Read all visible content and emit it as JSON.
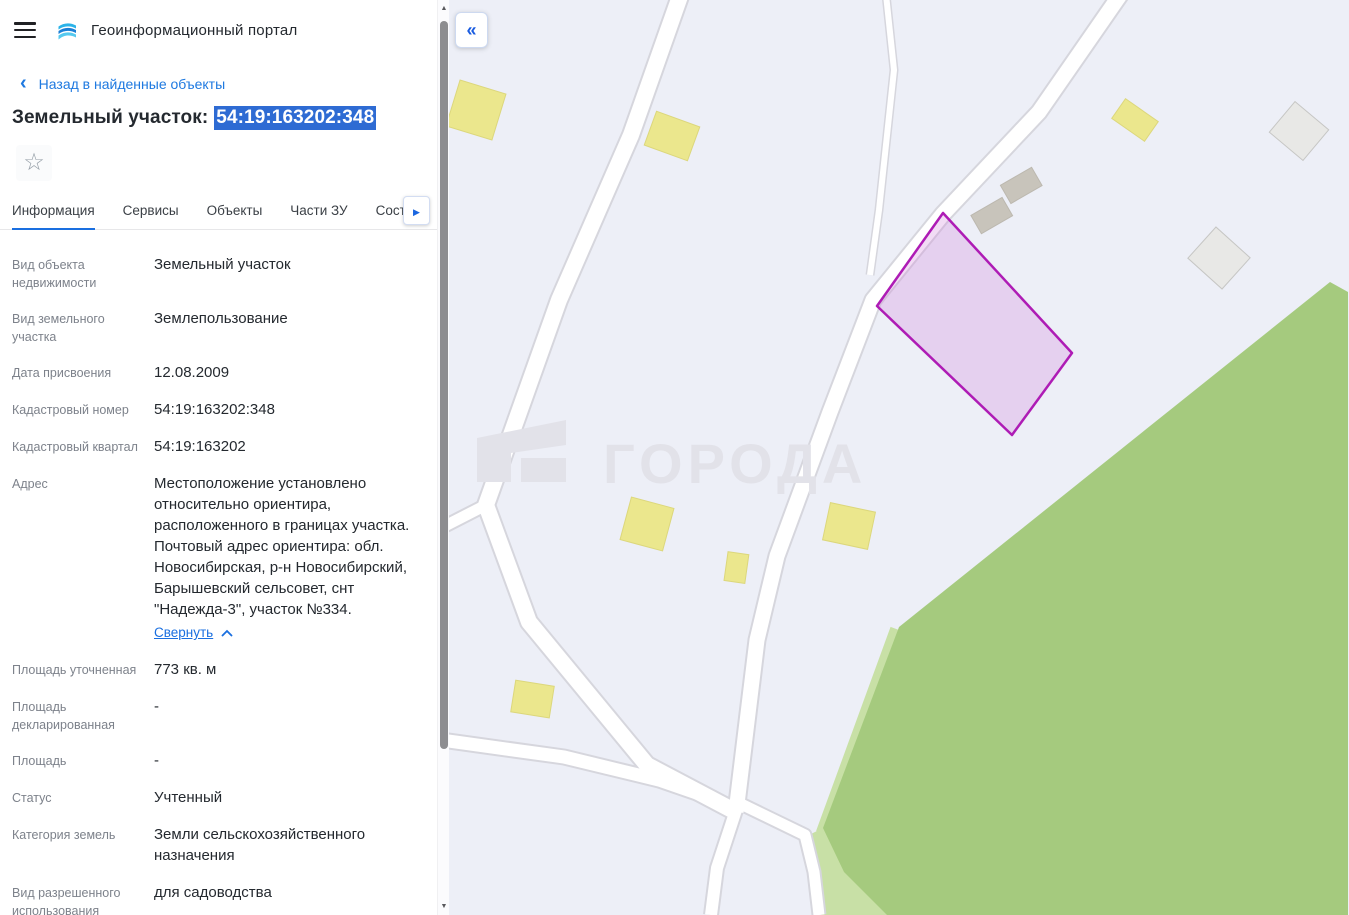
{
  "header": {
    "title": "Геоинформационный портал"
  },
  "back_link": {
    "label": "Назад в найденные объекты"
  },
  "object": {
    "title_prefix": "Земельный участок:",
    "cadastral_number": "54:19:163202:348"
  },
  "icons": {
    "back_chevron": "‹",
    "star": "☆",
    "tabs_scroll_right": "▶",
    "map_collapse": "«",
    "scroll_up": "▲",
    "scroll_down": "▼"
  },
  "tabs": [
    {
      "label": "Информация",
      "active": true
    },
    {
      "label": "Сервисы",
      "active": false
    },
    {
      "label": "Объекты",
      "active": false
    },
    {
      "label": "Части ЗУ",
      "active": false
    },
    {
      "label": "Соста",
      "active": false,
      "truncated": true
    }
  ],
  "fields": [
    {
      "label": "Вид объекта недвижимости",
      "value": "Земельный участок"
    },
    {
      "label": "Вид земельного участка",
      "value": "Землепользование"
    },
    {
      "label": "Дата присвоения",
      "value": "12.08.2009"
    },
    {
      "label": "Кадастровый номер",
      "value": "54:19:163202:348"
    },
    {
      "label": "Кадастровый квартал",
      "value": "54:19:163202"
    },
    {
      "label": "Адрес",
      "value": "Местоположение установлено относительно ориентира, расположенного в границах участка. Почтовый адрес ориентира: обл. Новосибирская, р-н Новосибирский, Барышевский сельсовет, снт \"Надежда-3\", участок №334.",
      "collapse_label": "Свернуть"
    },
    {
      "label": "Площадь уточненная",
      "value": "773 кв. м"
    },
    {
      "label": "Площадь декларированная",
      "value": "-"
    },
    {
      "label": "Площадь",
      "value": "-"
    },
    {
      "label": "Статус",
      "value": "Учтенный"
    },
    {
      "label": "Категория земель",
      "value": "Земли сельскохозяйственного назначения"
    },
    {
      "label": "Вид разрешенного использования",
      "value": "для садоводства"
    }
  ],
  "map": {
    "watermark": "ГОРОДА"
  },
  "colors": {
    "accent_blue": "#1a6fe0",
    "selection_blue": "#2e6bd3",
    "map_background": "#edeff7",
    "map_green": "#a5ca7e",
    "map_green_light": "#c8e0a6",
    "building_yellow": "#ebe78d",
    "building_gray": "#c8c4bb",
    "building_light_gray": "#e8e8e6",
    "road_white": "#ffffff",
    "road_casing": "#d6d6dd",
    "parcel_fill": "#e9d4f0",
    "parcel_stroke": "#ae1cb5",
    "watermark_gray": "#e2e2e9"
  }
}
